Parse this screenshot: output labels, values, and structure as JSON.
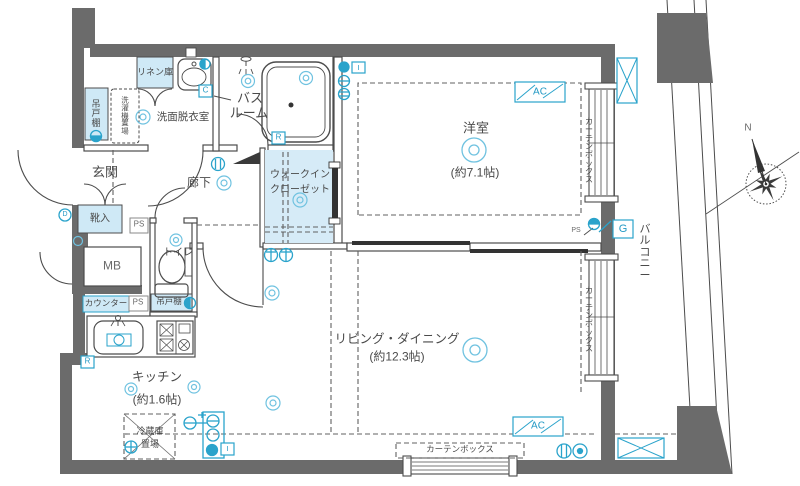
{
  "rooms": {
    "bedroom": {
      "name": "洋室",
      "size": "(約7.1帖)"
    },
    "living": {
      "name": "リビング・ダイニング",
      "size": "(約12.3帖)"
    },
    "kitchen": {
      "name": "キッチン",
      "size": "(約1.6帖)"
    },
    "entrance": {
      "name": "玄関"
    },
    "hallway": {
      "name": "廊下"
    },
    "bath": {
      "line1": "バス",
      "line2": "ルーム"
    },
    "washroom": {
      "name": "洗面脱衣室"
    },
    "toilet": {
      "name": "トイレ"
    },
    "walk_in_closet": {
      "line1": "ウォークイン",
      "line2": "クローゼット"
    },
    "balcony": {
      "name": "バルコニー"
    }
  },
  "labels": {
    "linen": "リネン庫",
    "hanging_cupboard": "吊戸棚",
    "washer_space": "洗濯機置場",
    "shoe_cabinet": "靴入",
    "meter_box": "MB",
    "pipe_space": "PS",
    "counter": "カウンター",
    "kitchen_cupboard": "吊戸棚",
    "fridge_line1": "冷蔵庫",
    "fridge_line2": "置場",
    "curtain_box": "カーテンボックス",
    "ac": "AC",
    "gas": "G",
    "north": "N",
    "letter_c": "C",
    "letter_r": "R",
    "letter_d": "D",
    "letter_i": "I"
  },
  "icons": {
    "ceiling_light": "double-circle",
    "wall_outlet": "crossed-circ",
    "ac_outdoor_slot": "crossed-box",
    "compass": "eight-point-rose"
  },
  "colors": {
    "wall": "#6b6b6b",
    "line": "#4c4c4c",
    "accent_blue": "#2aa3cb",
    "light_blue_fill": "#cfe9f6",
    "text": "#4a4a4a"
  }
}
